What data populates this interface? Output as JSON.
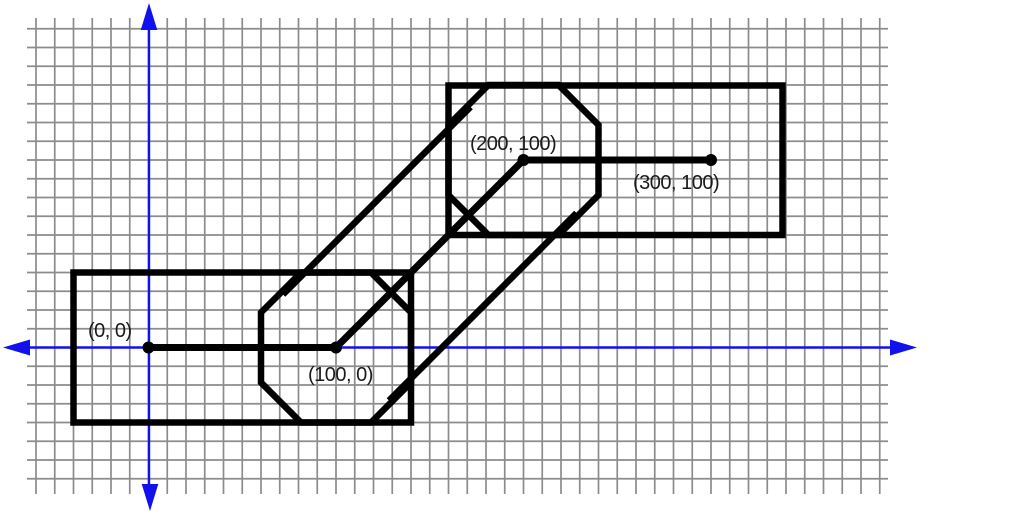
{
  "figure": {
    "points": [
      {
        "label": "(0, 0)",
        "x": 0,
        "y": 0
      },
      {
        "label": "(100, 0)",
        "x": 100,
        "y": 0
      },
      {
        "label": "(200, 100)",
        "x": 200,
        "y": 100
      },
      {
        "label": "(300, 100)",
        "x": 300,
        "y": 100
      }
    ],
    "colors": {
      "axis_blue": "#1111ee",
      "shape_black": "#000000",
      "grid_gray": "#8c8c8c",
      "label_text": "#1a1a1a",
      "background": "#ffffff"
    }
  }
}
